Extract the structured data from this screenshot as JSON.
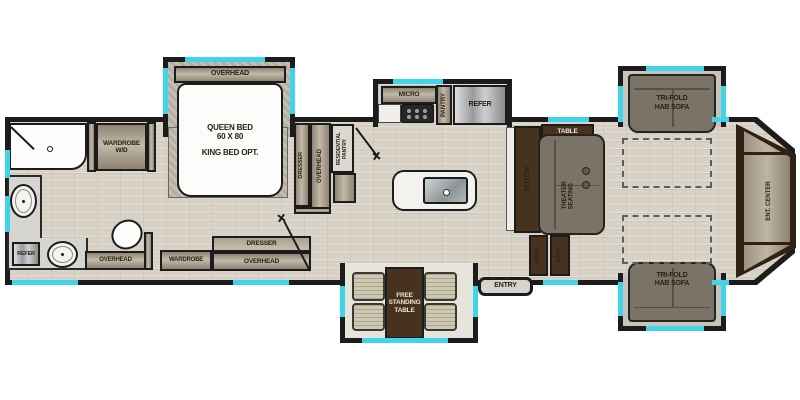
{
  "title": "Fifth wheel RV floor plan",
  "colors": {
    "wall": "#1c1c1c",
    "window_accent": "#3fd4e8",
    "cabinet_tan": "#b5aa99",
    "furniture_brown": "#46321f",
    "sofa_taupe": "#7b7366",
    "floor": "#d9d3c7"
  },
  "bath": {
    "wardrobe_wd_l1": "WARDROBE",
    "wardrobe_wd_l2": "W/D",
    "refer": "REFER",
    "overhead": "OVERHEAD"
  },
  "bedroom": {
    "overhead_slide": "OVERHEAD",
    "bed_l1": "QUEEN BED",
    "bed_l2": "60 X 80",
    "bed_l3": "KING BED OPT.",
    "wardrobe": "WARDROBE",
    "dresser_strip": "DRESSER",
    "overhead_strip": "OVERHEAD",
    "dresser_vert": "DRESSER",
    "overhead_vert": "OVERHEAD"
  },
  "kitchen": {
    "residential_pantry_l1": "RESIDENTIAL",
    "residential_pantry_l2": "PANTRY",
    "micro": "MICRO",
    "pantry": "PANTRY",
    "refer": "REFER"
  },
  "living": {
    "table": "TABLE",
    "hutch": "HUTCH",
    "theater_seating": "THEATER SEATING",
    "step_1": "STEP",
    "step_2": "STEP",
    "sofa_top_l1": "TRI-FOLD",
    "sofa_top_l2": "HAB SOFA",
    "sofa_bottom_l1": "TRI-FOLD",
    "sofa_bottom_l2": "HAB SOFA",
    "ent_center": "ENT. CENTER",
    "entry": "ENTRY"
  },
  "dinette": {
    "l1": "FREE",
    "l2": "STANDING",
    "l3": "TABLE"
  }
}
